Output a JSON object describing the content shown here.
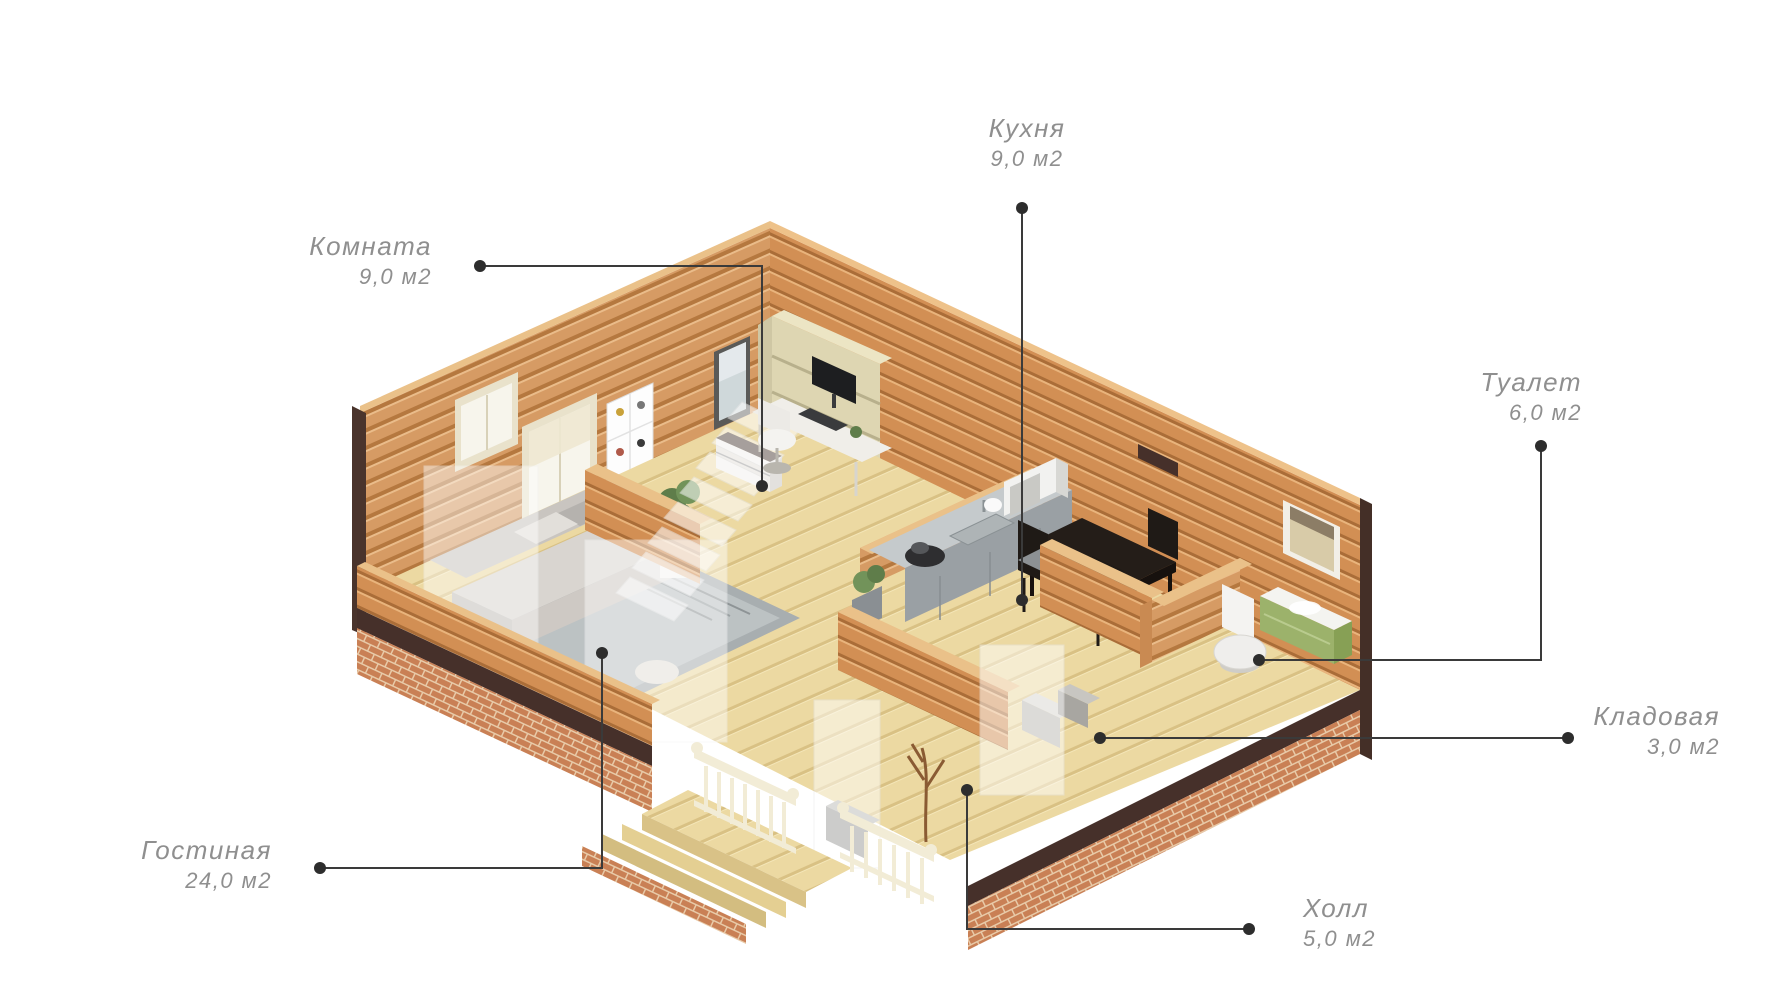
{
  "page": {
    "background": "#ffffff",
    "type": "isometric-floor-plan"
  },
  "colors": {
    "wall_wood": "#d59557",
    "wall_wood_stripe": "#b3743c",
    "wall_top_edge": "#eac189",
    "floor_wood": "#ecd9a2",
    "floor_stripe": "#d9c184",
    "brick": "#c98055",
    "brick_mortar": "#e8caa8",
    "trim_dark": "#46302a",
    "label_text": "#8f8f8f",
    "leader_line": "#3a3a3a",
    "railing_cream": "#f2ecd6",
    "vanity_green": "#9cb26b",
    "counter_gray": "#9aa0a4"
  },
  "rooms": [
    {
      "id": "kitchen",
      "name": "Кухня",
      "area": "9,0 м2",
      "label": {
        "x": 1027,
        "y": 112,
        "align": "center"
      },
      "leader": [
        [
          1022,
          208
        ],
        [
          1022,
          600
        ]
      ]
    },
    {
      "id": "room",
      "name": "Комната",
      "area": "9,0 м2",
      "label": {
        "x": 432,
        "y": 230,
        "align": "right"
      },
      "leader": [
        [
          480,
          266
        ],
        [
          762,
          266
        ],
        [
          762,
          486
        ]
      ]
    },
    {
      "id": "toilet",
      "name": "Туалет",
      "area": "6,0 м2",
      "label": {
        "x": 1582,
        "y": 366,
        "align": "right"
      },
      "leader": [
        [
          1541,
          446
        ],
        [
          1541,
          660
        ],
        [
          1259,
          660
        ]
      ]
    },
    {
      "id": "storage",
      "name": "Кладовая",
      "area": "3,0 м2",
      "label": {
        "x": 1720,
        "y": 700,
        "align": "right"
      },
      "leader": [
        [
          1568,
          738
        ],
        [
          1100,
          738
        ]
      ]
    },
    {
      "id": "living",
      "name": "Гостиная",
      "area": "24,0 м2",
      "label": {
        "x": 272,
        "y": 834,
        "align": "right"
      },
      "leader": [
        [
          320,
          868
        ],
        [
          602,
          868
        ],
        [
          602,
          653
        ]
      ]
    },
    {
      "id": "hall",
      "name": "Холл",
      "area": "5,0 м2",
      "label": {
        "x": 1303,
        "y": 892,
        "align": "left"
      },
      "leader": [
        [
          1249,
          929
        ],
        [
          967,
          929
        ],
        [
          967,
          790
        ]
      ]
    }
  ],
  "scene": {
    "objects": [
      "sofa",
      "rug",
      "sheer-curtain",
      "bookshelf",
      "wall-mirror",
      "cat-poster",
      "window",
      "desk",
      "monitor",
      "office-chair",
      "ghost-staircase",
      "kitchen-counter",
      "sink",
      "cooktop",
      "microwave",
      "dining-table",
      "dining-chair",
      "toilet",
      "green-vanity",
      "bathroom-mirror",
      "wall-heater",
      "plant",
      "storage-boxes",
      "ghost-door",
      "coat-rack",
      "shoe-cabinet",
      "porch-steps",
      "porch-railing",
      "brick-foundation"
    ]
  }
}
